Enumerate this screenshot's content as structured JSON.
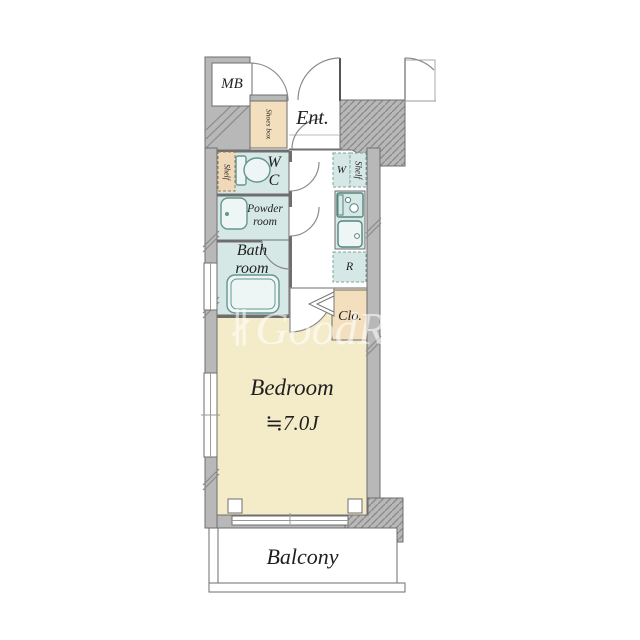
{
  "floorplan": {
    "rooms": {
      "mb": "MB",
      "ent": "Ent.",
      "shoes_box": "Shoes box",
      "wc_shelf": "Shelf",
      "wc_w": "W",
      "wc_c": "C",
      "washer": "W",
      "kitchen_shelf": "Shelf",
      "powder_1": "Powder",
      "powder_2": "room",
      "bath_1": "Bath",
      "bath_2": "room",
      "fridge": "R",
      "closet": "Clo.",
      "bedroom": "Bedroom",
      "bedroom_size": "≒7.0J",
      "balcony": "Balcony"
    },
    "watermark": {
      "mark": "∦",
      "text": "GoodRoom"
    },
    "colors": {
      "wall": "#b8b8b8",
      "wet": "#d6e8e5",
      "bedroom": "#f4ebc9",
      "storage": "#f3dfbe"
    }
  }
}
